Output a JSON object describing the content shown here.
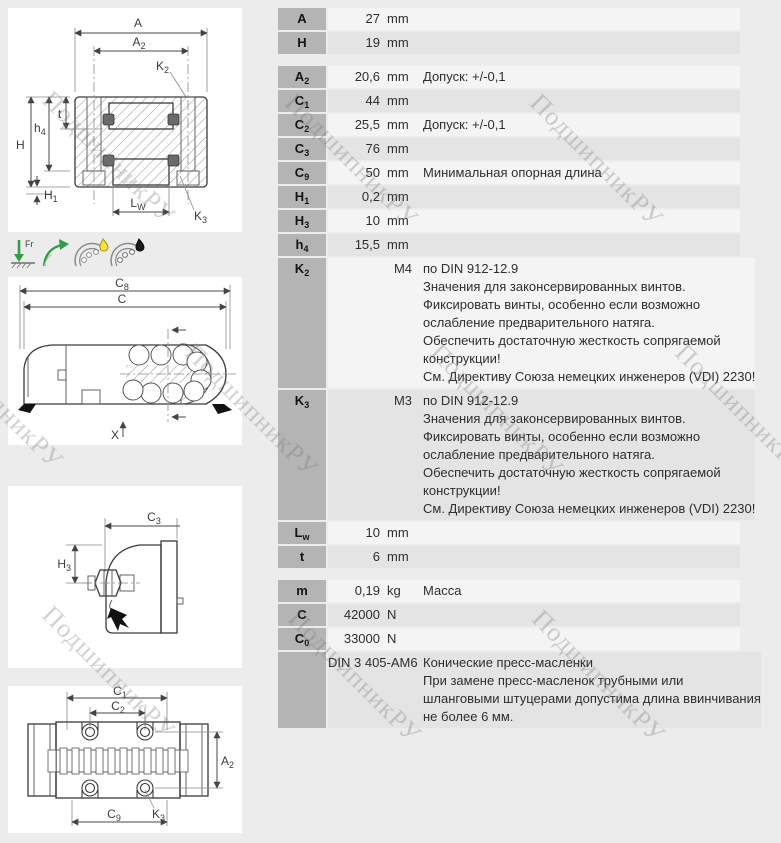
{
  "watermark": {
    "text": "ПодшипникРУ",
    "positions": [
      {
        "x": 57,
        "y": 85
      },
      {
        "x": 300,
        "y": 88
      },
      {
        "x": 545,
        "y": 88
      },
      {
        "x": -55,
        "y": 330
      },
      {
        "x": 200,
        "y": 338
      },
      {
        "x": 445,
        "y": 338
      },
      {
        "x": 690,
        "y": 338
      },
      {
        "x": 57,
        "y": 600
      },
      {
        "x": 303,
        "y": 604
      },
      {
        "x": 547,
        "y": 604
      }
    ]
  },
  "table": {
    "sections": [
      {
        "rows": [
          {
            "label": "A",
            "sub": "",
            "value": "27",
            "unit": "mm",
            "desc": []
          },
          {
            "label": "H",
            "sub": "",
            "value": "19",
            "unit": "mm",
            "desc": []
          }
        ]
      },
      {
        "rows": [
          {
            "label": "A",
            "sub": "2",
            "value": "20,6",
            "unit": "mm",
            "desc": [
              "Допуск: +/-0,1"
            ]
          },
          {
            "label": "C",
            "sub": "1",
            "value": "44",
            "unit": "mm",
            "desc": []
          },
          {
            "label": "C",
            "sub": "2",
            "value": "25,5",
            "unit": "mm",
            "desc": [
              "Допуск: +/-0,1"
            ]
          },
          {
            "label": "C",
            "sub": "3",
            "value": "76",
            "unit": "mm",
            "desc": []
          },
          {
            "label": "C",
            "sub": "9",
            "value": "50",
            "unit": "mm",
            "desc": [
              "Минимальная опорная длина"
            ]
          },
          {
            "label": "H",
            "sub": "1",
            "value": "0,2",
            "unit": "mm",
            "desc": []
          },
          {
            "label": "H",
            "sub": "3",
            "value": "10",
            "unit": "mm",
            "desc": []
          },
          {
            "label": "h",
            "sub": "4",
            "value": "15,5",
            "unit": "mm",
            "desc": []
          },
          {
            "label": "K",
            "sub": "2",
            "value": "M4",
            "unit": "",
            "desc": [
              "по DIN 912-12.9",
              "Значения для законсервированных винтов.",
              "Фиксировать винты, особенно если возможно",
              "ослабление предварительного натяга.",
              "Обеспечить достаточную жесткость сопрягаемой",
              "конструкции!",
              "См. Директиву Союза немецких инженеров (VDI) 2230!"
            ]
          },
          {
            "label": "K",
            "sub": "3",
            "value": "M3",
            "unit": "",
            "desc": [
              "по DIN 912-12.9",
              "Значения для законсервированных винтов.",
              "Фиксировать винты, особенно если возможно",
              "ослабление предварительного натяга.",
              "Обеспечить достаточную жесткость сопрягаемой",
              "конструкции!",
              "См. Директиву Союза немецких инженеров (VDI) 2230!"
            ]
          },
          {
            "label": "L",
            "sub": "w",
            "value": "10",
            "unit": "mm",
            "desc": []
          },
          {
            "label": "t",
            "sub": "",
            "value": "6",
            "unit": "mm",
            "desc": []
          }
        ]
      },
      {
        "rows": [
          {
            "label": "m",
            "sub": "",
            "value": "0,19",
            "unit": "kg",
            "desc": [
              "Масса"
            ]
          },
          {
            "label": "C",
            "sub": "",
            "value": "42000",
            "unit": "N",
            "desc": []
          },
          {
            "label": "C",
            "sub": "0",
            "value": "33000",
            "unit": "N",
            "desc": []
          },
          {
            "label": "",
            "sub": "",
            "value": "DIN 3 405-AM6",
            "unit": "",
            "desc": [
              "Конические пресс-масленки",
              "При замене пресс-масленок трубными или",
              "шланговыми штуцерами допустима длина ввинчивания",
              "не более 6 мм."
            ]
          }
        ]
      }
    ]
  },
  "drawings": {
    "front": {
      "A": {
        "b": "A",
        "s": ""
      },
      "A2": {
        "b": "A",
        "s": "2"
      },
      "K2": {
        "b": "K",
        "s": "2"
      },
      "H": {
        "b": "H",
        "s": ""
      },
      "h4": {
        "b": "h",
        "s": "4"
      },
      "t": {
        "b": "t",
        "s": ""
      },
      "H1": {
        "b": "H",
        "s": "1"
      },
      "Lw": {
        "b": "L",
        "s": "W"
      },
      "K3": {
        "b": "K",
        "s": "3"
      }
    },
    "side": {
      "C8": {
        "b": "C",
        "s": "8"
      },
      "C": {
        "b": "C",
        "s": ""
      },
      "X": {
        "b": "X",
        "s": ""
      }
    },
    "end": {
      "C3": {
        "b": "C",
        "s": "3"
      },
      "H3": {
        "b": "H",
        "s": "3"
      }
    },
    "top": {
      "C1": {
        "b": "C",
        "s": "1"
      },
      "C2": {
        "b": "C",
        "s": "2"
      },
      "A2": {
        "b": "A",
        "s": "2"
      },
      "K3": {
        "b": "K",
        "s": "3"
      },
      "C9": {
        "b": "C",
        "s": "9"
      }
    }
  },
  "icons": {
    "fr_label": "Fr"
  }
}
